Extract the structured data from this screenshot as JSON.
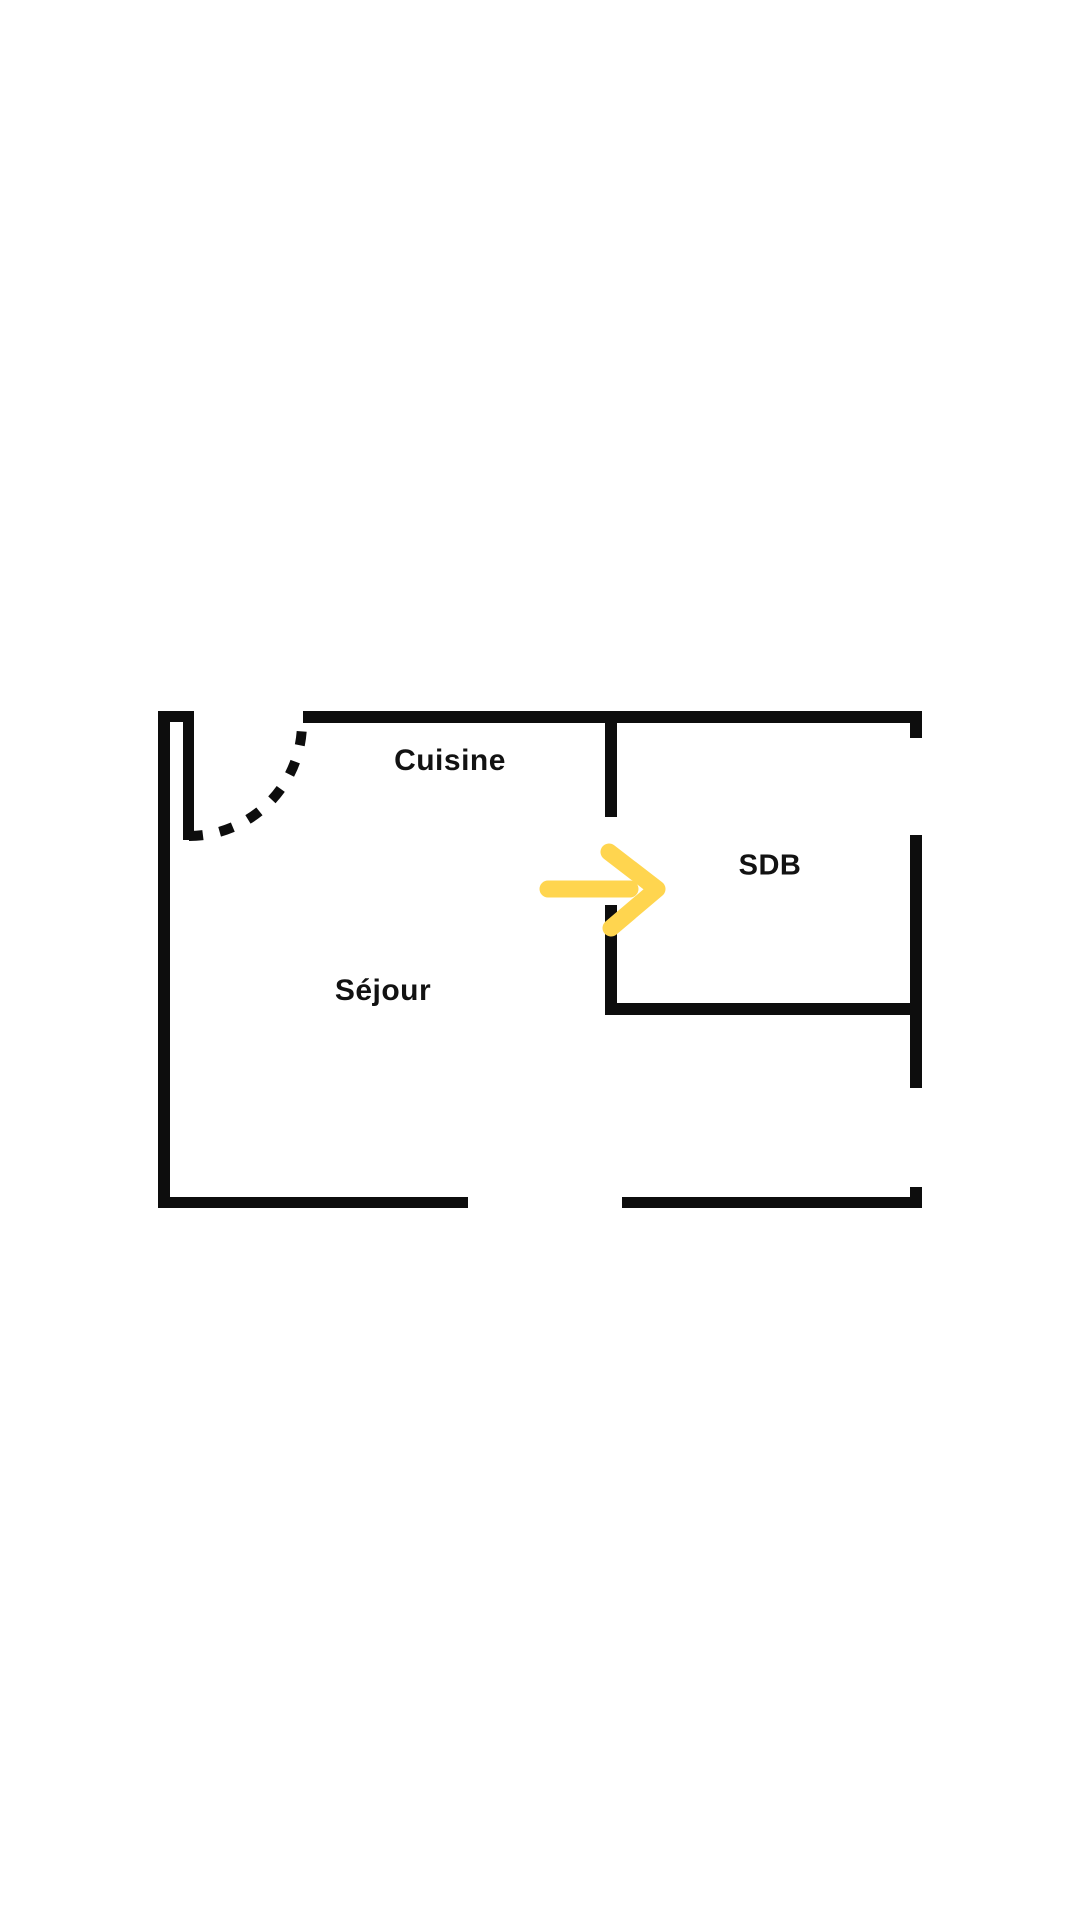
{
  "colors": {
    "background": "#ffffff",
    "wall": "#0d0d0d",
    "text": "#121212",
    "arrow": "#ffd54f"
  },
  "floor_plan": {
    "rooms": [
      {
        "id": "cuisine",
        "label": "Cuisine"
      },
      {
        "id": "sejour",
        "label": "Séjour"
      },
      {
        "id": "sdb",
        "label": "SDB"
      }
    ],
    "icons": {
      "direction_arrow": "arrow-right",
      "door_swing": "dashed-quarter-arc"
    }
  }
}
